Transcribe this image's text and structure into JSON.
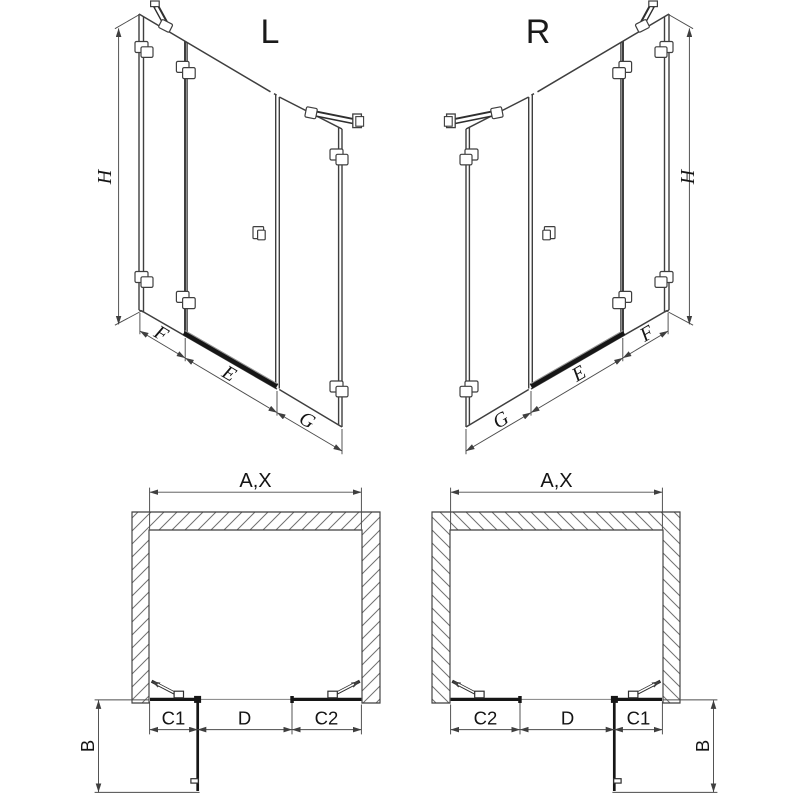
{
  "document": {
    "type": "shower-enclosure-dimension-diagram",
    "background": "#ffffff"
  },
  "colors": {
    "line": "#3f3f3f",
    "heavy_line": "#161616",
    "dim_line": "#4c4c4c",
    "hatch": "#707070",
    "text": "#141414"
  },
  "views": {
    "perspective_left": {
      "label": "L",
      "height": "H",
      "front_fixed": "F",
      "door": "E",
      "side_fixed": "G"
    },
    "perspective_right": {
      "label": "R",
      "height": "H",
      "front_fixed": "F",
      "door": "E",
      "side_fixed": "G"
    },
    "plan_left": {
      "width": "A,X",
      "seg_left": "C1",
      "seg_mid": "D",
      "seg_right": "C2",
      "depth": "B"
    },
    "plan_right": {
      "width": "A,X",
      "seg_left": "C2",
      "seg_mid": "D",
      "seg_right": "C1",
      "depth": "B"
    }
  }
}
